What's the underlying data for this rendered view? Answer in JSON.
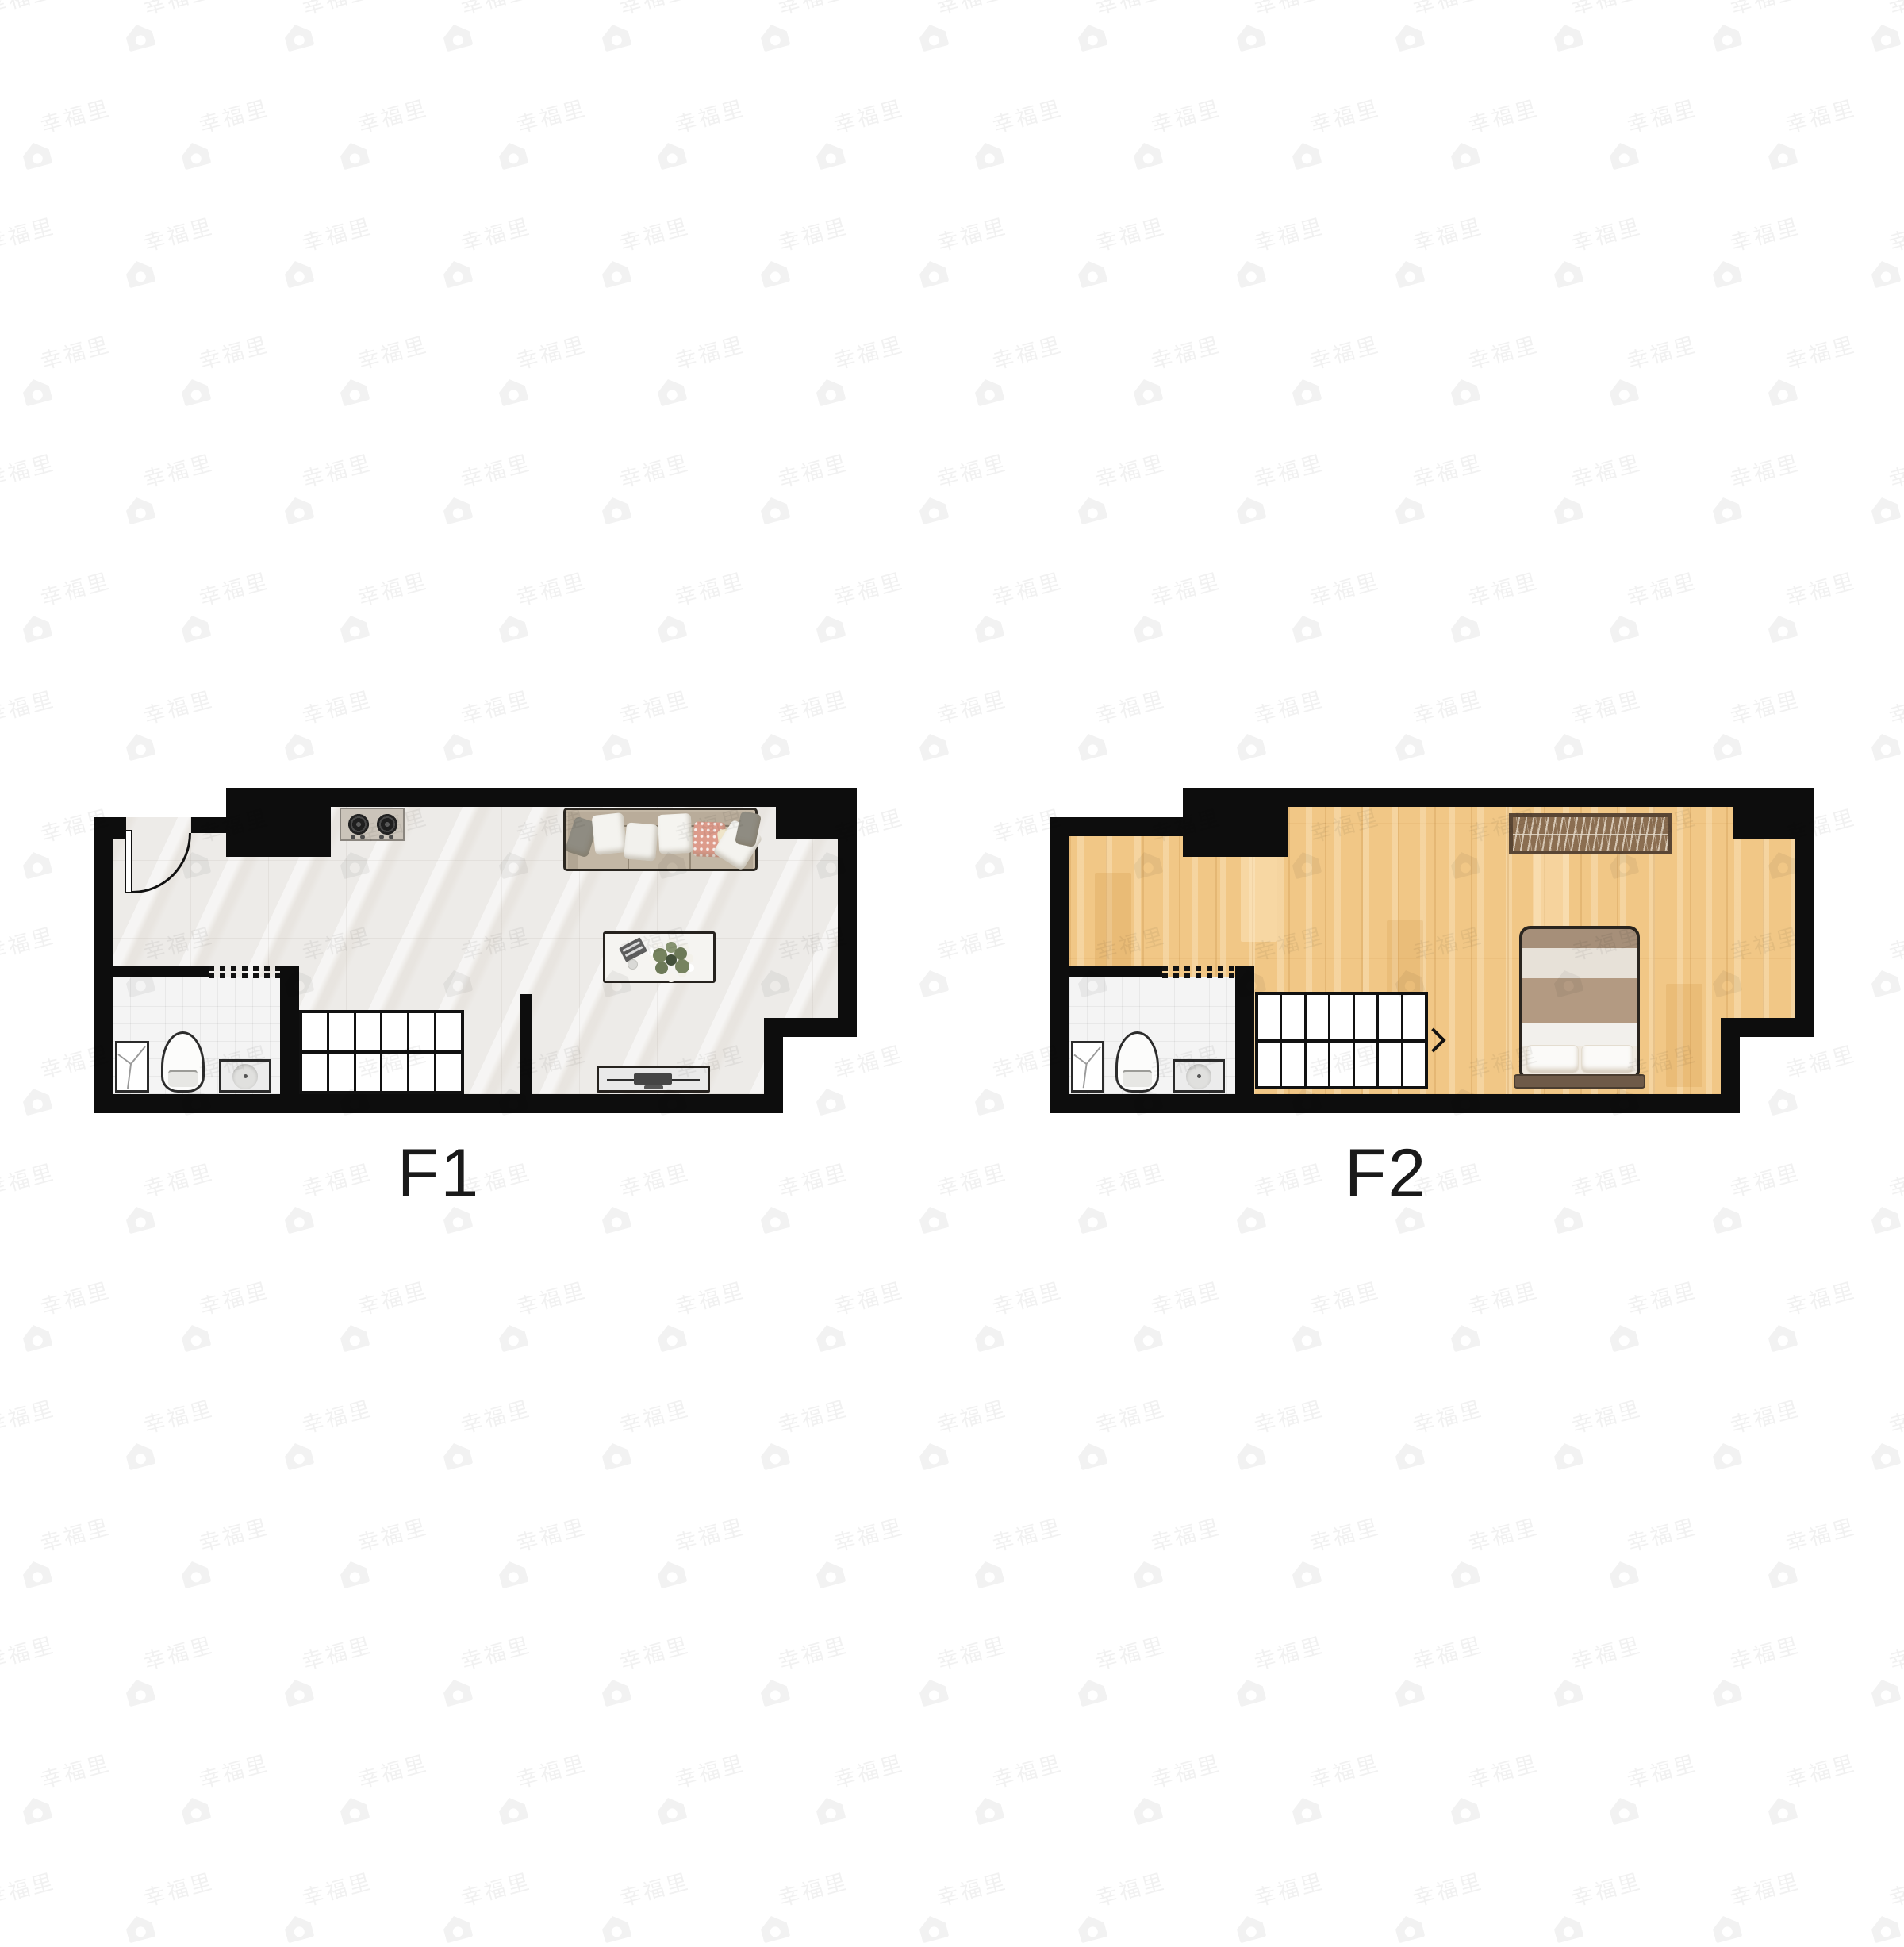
{
  "watermark": {
    "text": "幸福里"
  },
  "floors": [
    {
      "label": "F1",
      "rooms": [
        "living-dining-kitchen",
        "bathroom"
      ],
      "furniture": [
        "entry-door",
        "gas-stove",
        "sofa",
        "coffee-table",
        "plant",
        "tv-stand",
        "toilet",
        "wash-basin",
        "shower-tray",
        "staircase"
      ],
      "stair_columns": 6,
      "stair_arrow": "left",
      "floor_material": "marble-tile"
    },
    {
      "label": "F2",
      "rooms": [
        "bedroom",
        "bathroom"
      ],
      "furniture": [
        "wardrobe",
        "double-bed",
        "pillows",
        "toilet",
        "wash-basin",
        "shower-tray",
        "staircase"
      ],
      "stair_columns": 7,
      "stair_arrow": "right",
      "floor_material": "wood-plank"
    }
  ],
  "colors": {
    "background": "#ffffff",
    "wall": "#0d0d0d",
    "marble_floor": "#edebe8",
    "wood_floor": "#f1c786",
    "bathroom_floor": "#f4f4f4",
    "stairs": "#ffffff",
    "sofa": "#c3b7a5",
    "accent_pillow": "#dd9b8b",
    "wardrobe": "#8b6e51",
    "bed_blanket": "#b39a82",
    "label_text": "#1a1a1a",
    "watermark": "rgba(0,0,0,0.055)"
  }
}
